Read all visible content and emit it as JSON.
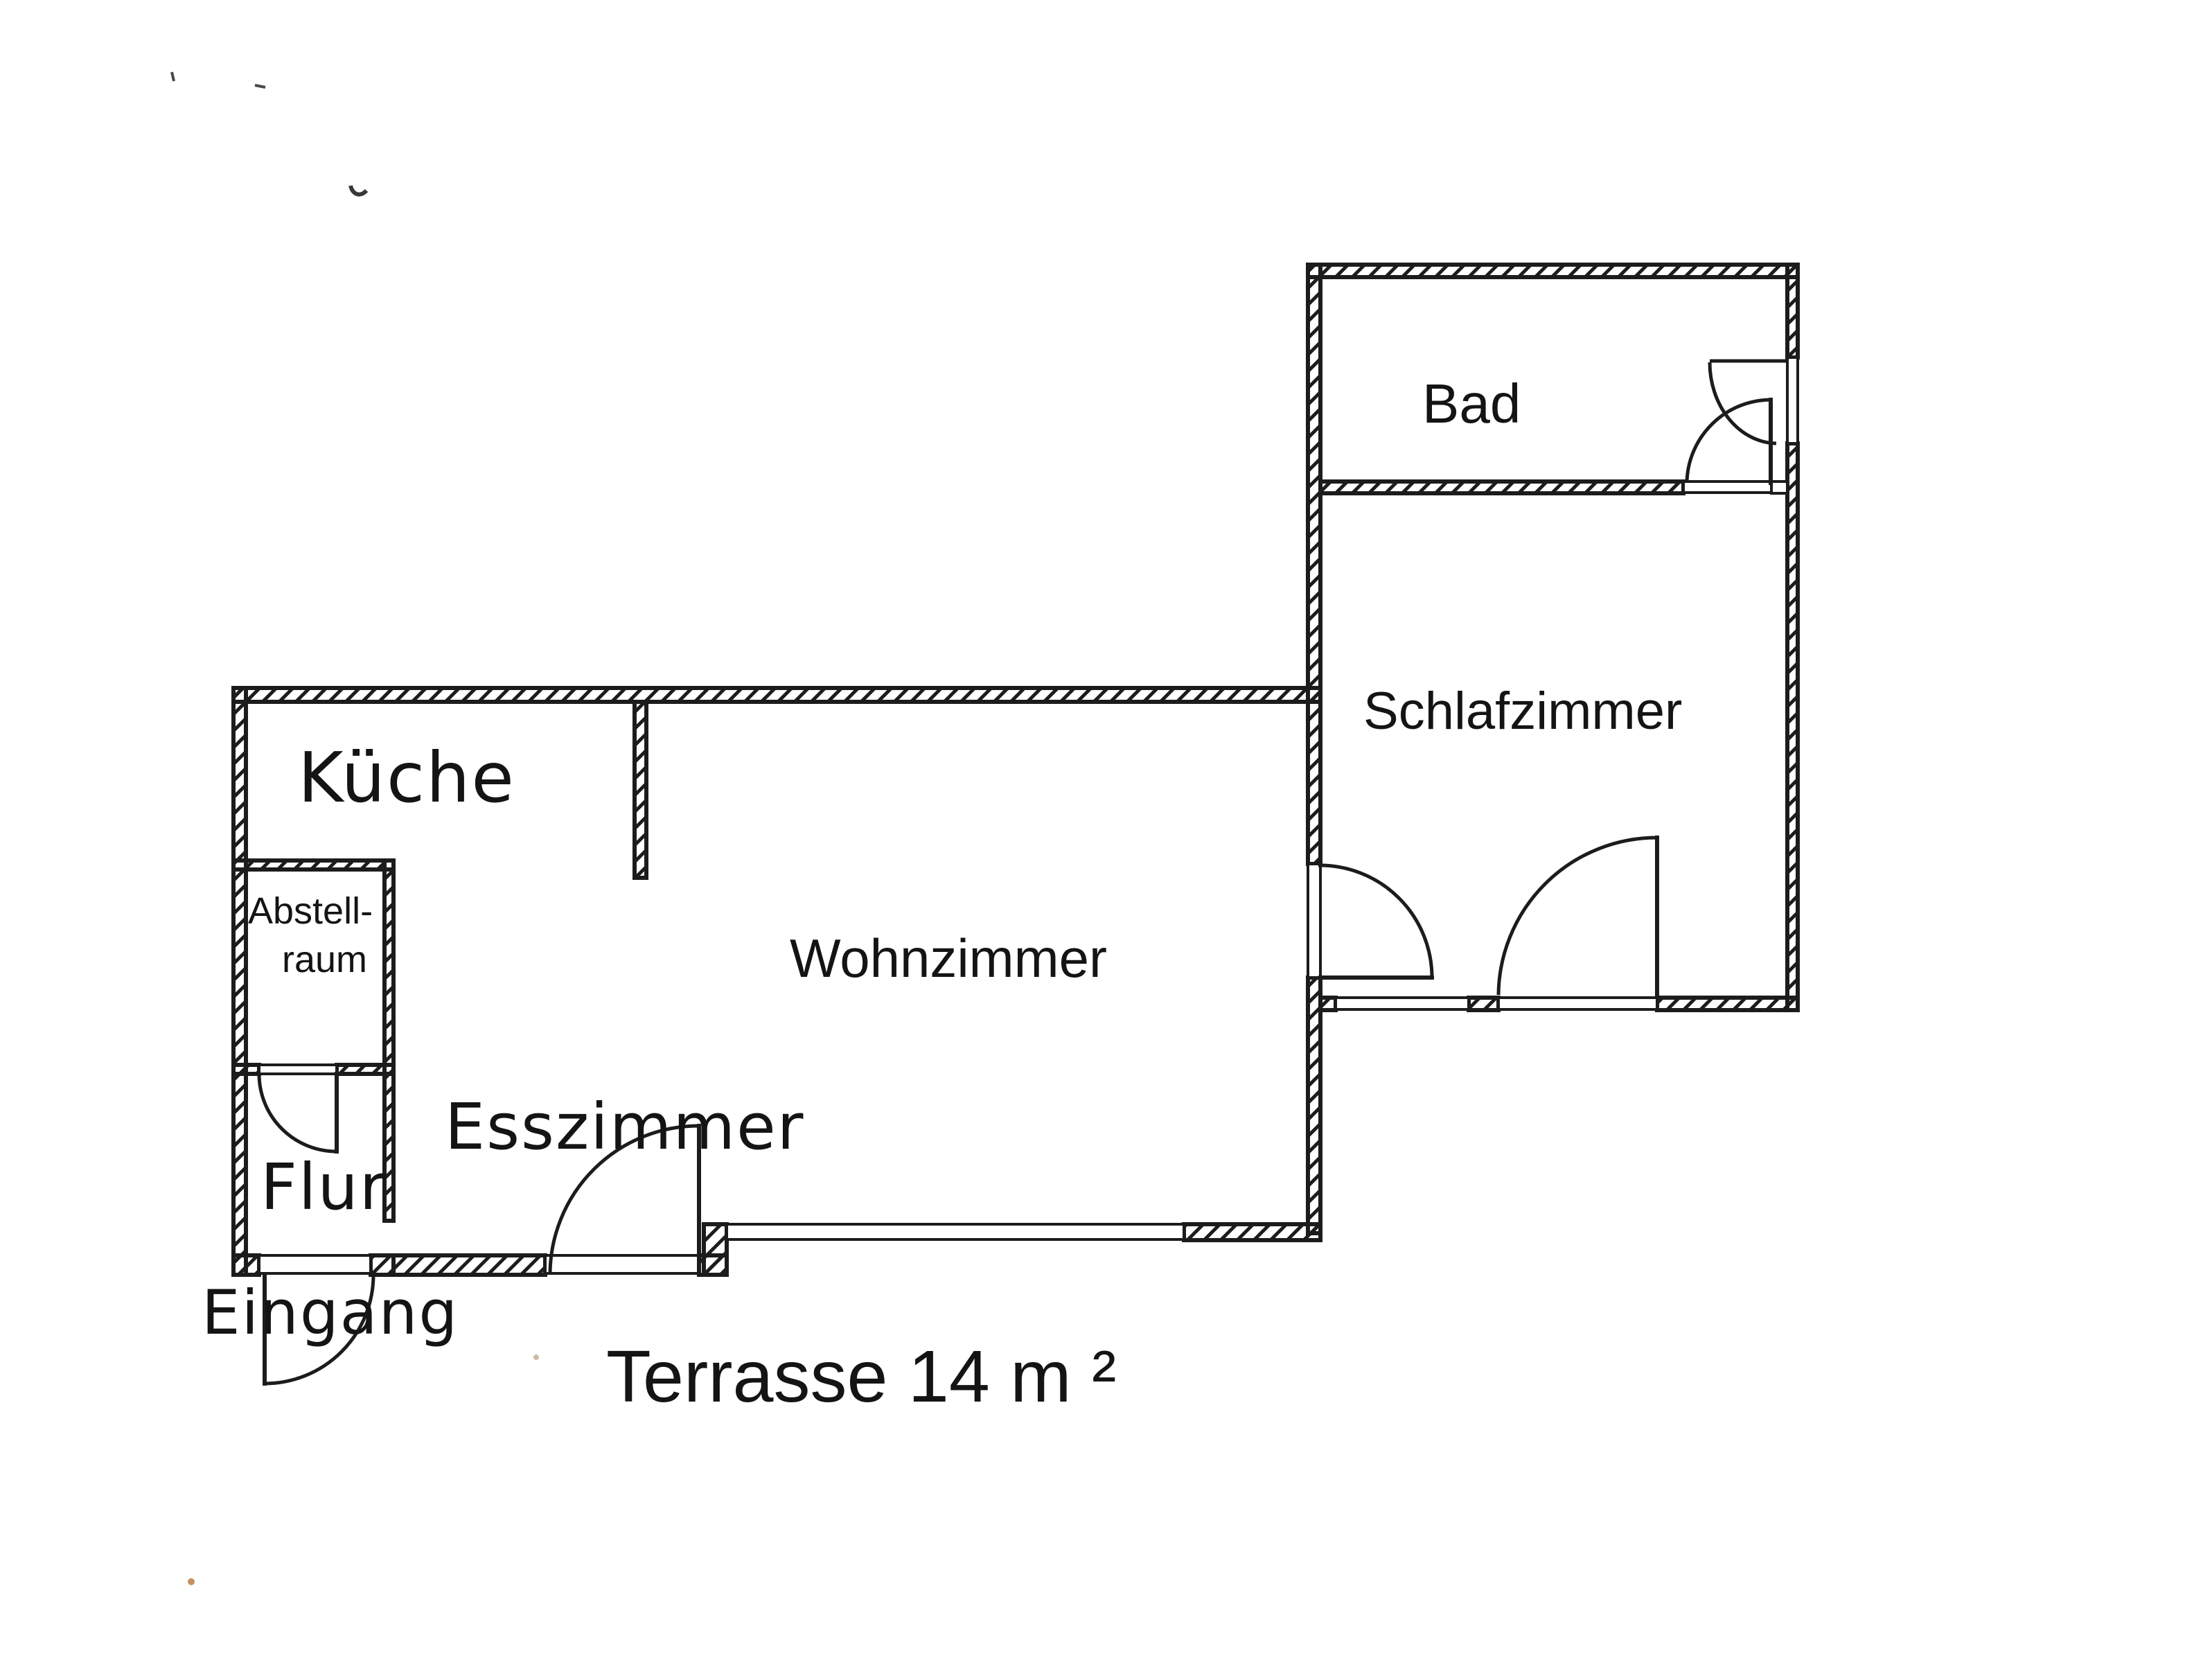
{
  "document": {
    "type": "scanned-floor-plan",
    "language": "de"
  },
  "colors": {
    "ink": "#1c1c1c",
    "paper": "#ffffff",
    "artifact_orange": "#c0854f",
    "artifact_tan": "#c6b59d"
  },
  "rooms": {
    "kueche": {
      "label": "Küche"
    },
    "abstellraum": {
      "label_line1": "Abstell-",
      "label_line2": "raum"
    },
    "flur": {
      "label": "Flur"
    },
    "esszimmer": {
      "label": "Esszimmer"
    },
    "wohnzimmer": {
      "label": "Wohnzimmer"
    },
    "schlafzimmer": {
      "label": "Schlafzimmer"
    },
    "bad": {
      "label": "Bad"
    }
  },
  "annotations": {
    "eingang": {
      "label": "Eingang"
    },
    "terrasse": {
      "label": "Terrasse 14 m ²"
    }
  }
}
